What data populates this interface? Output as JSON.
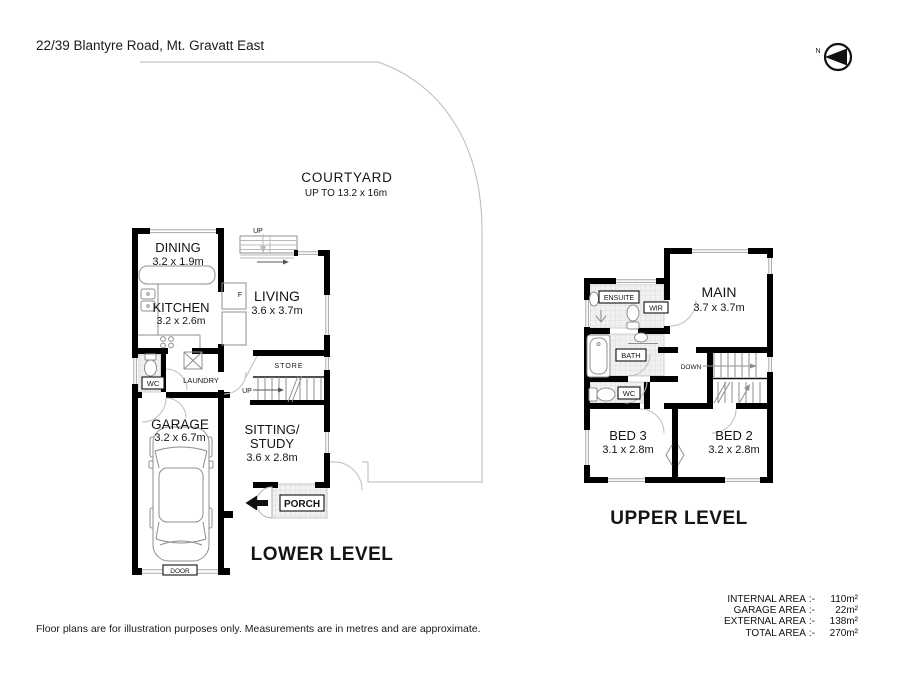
{
  "title": "22/39 Blantyre Road, Mt. Gravatt East",
  "north_label": "N",
  "courtyard": {
    "name": "COURTYARD",
    "dims": "UP TO 13.2 x 16m"
  },
  "lower": {
    "level_label": "LOWER LEVEL",
    "rooms": {
      "dining": {
        "name": "DINING",
        "dims": "3.2 x 1.9m"
      },
      "kitchen": {
        "name": "KITCHEN",
        "dims": "3.2 x 2.6m"
      },
      "living": {
        "name": "LIVING",
        "dims": "3.6 x 3.7m"
      },
      "garage": {
        "name": "GARAGE",
        "dims": "3.2 x 6.7m"
      },
      "sitting": {
        "name": "SITTING/",
        "name2": "STUDY",
        "dims": "3.6 x 2.8m"
      }
    },
    "labels": {
      "wc": "WC",
      "laundry": "LAUNDRY",
      "store": "STORE",
      "porch": "PORCH",
      "door": "DOOR",
      "fridge": "F",
      "up_stairs": "UP",
      "up_entry": "UP"
    }
  },
  "upper": {
    "level_label": "UPPER LEVEL",
    "rooms": {
      "main": {
        "name": "MAIN",
        "dims": "3.7 x 3.7m"
      },
      "bed3": {
        "name": "BED 3",
        "dims": "3.1 x 2.8m"
      },
      "bed2": {
        "name": "BED 2",
        "dims": "3.2 x 2.8m"
      }
    },
    "labels": {
      "ensuite": "ENSUITE",
      "wir": "WIR",
      "bath": "BATH",
      "wc": "WC",
      "down": "DOWN"
    }
  },
  "areas": {
    "rows": [
      {
        "label": "INTERNAL AREA",
        "sep": ":-",
        "value": "110m²"
      },
      {
        "label": "GARAGE AREA",
        "sep": ":-",
        "value": "22m²"
      },
      {
        "label": "EXTERNAL AREA",
        "sep": ":-",
        "value": "138m²"
      },
      {
        "label": "TOTAL AREA",
        "sep": ":-",
        "value": "270m²"
      }
    ]
  },
  "disclaimer": "Floor plans are for illustration purposes only. Measurements are in metres and are approximate.",
  "colors": {
    "wall": "#000000",
    "thin_line": "#b9b9b9",
    "tile_line": "#d8d8d8",
    "text": "#111111"
  }
}
